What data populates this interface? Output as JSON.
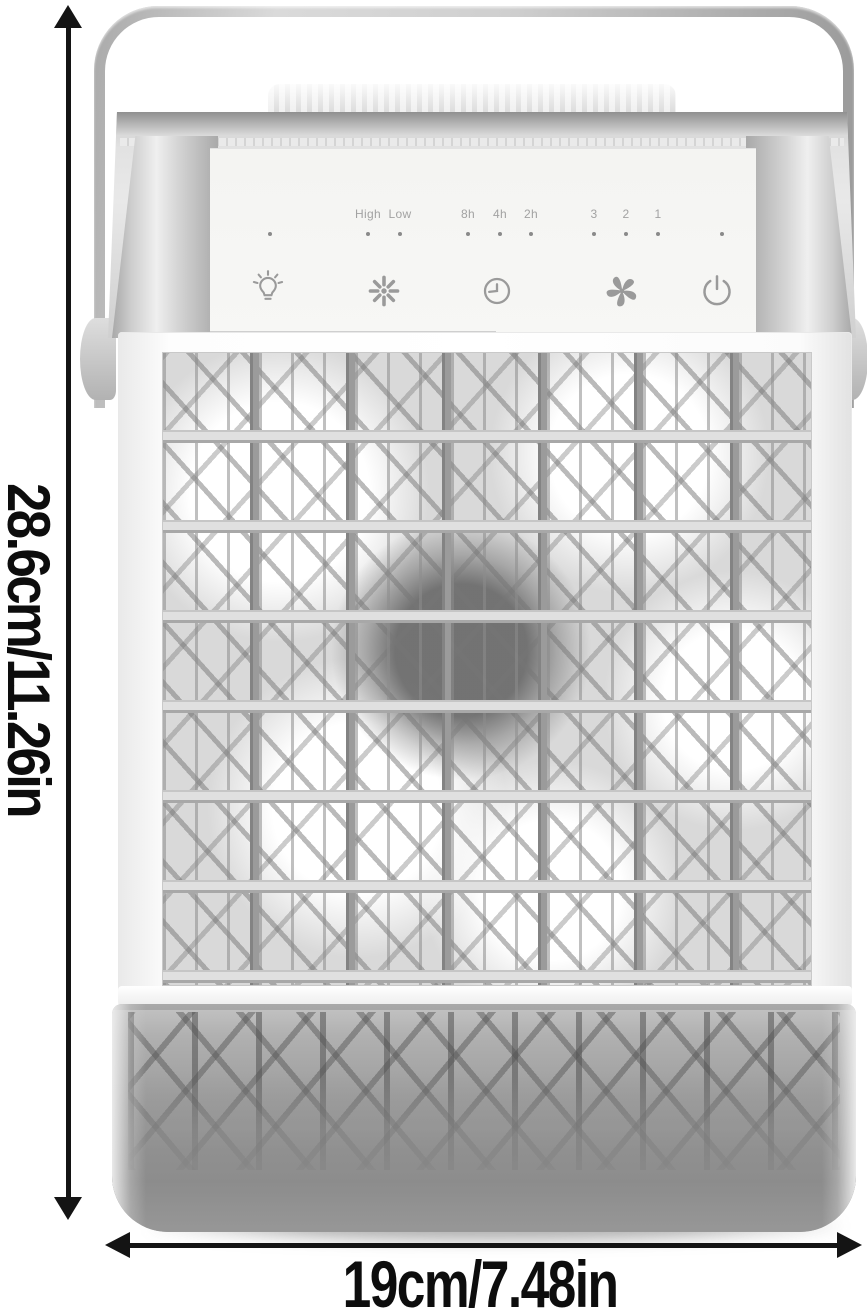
{
  "annotations": {
    "height_label": "28.6cm/11.26in",
    "width_label": "19cm/7.48in"
  },
  "control_panel": {
    "speed_labels": [
      "High",
      "Low"
    ],
    "timer_labels": [
      "8h",
      "4h",
      "2h"
    ],
    "level_labels": [
      "3",
      "2",
      "1"
    ],
    "icons": [
      "light-bulb-icon",
      "snowflake-icon",
      "timer-clock-icon",
      "fan-icon",
      "power-icon"
    ]
  },
  "colors": {
    "annotation_ink": "#141414",
    "panel_text": "#a2a2a2",
    "icon_stroke": "#9a9a9a",
    "grille_bar": "#8a8a8a",
    "tank_body": "#9d9d9d",
    "chrome": "#cfcfcf"
  }
}
